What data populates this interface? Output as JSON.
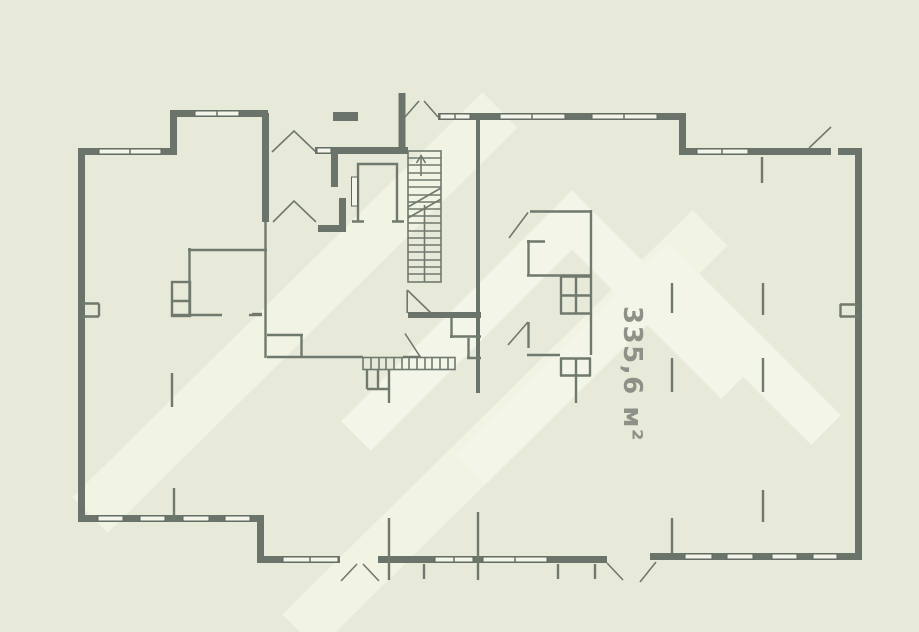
{
  "plan": {
    "area_label": "335,6 м²",
    "stairs": {
      "direction_icon": "up-arrow"
    },
    "watermark": {
      "shape": "double-chevron-logo-with-diagonal-stripes"
    },
    "colors": {
      "background": "#e8ead9",
      "wall": "#6b746a",
      "thin_line": "#70796e",
      "window_fill": "#f4f5ea",
      "watermark_light": "#f1f3e3",
      "area_text": "#8d9187"
    }
  }
}
